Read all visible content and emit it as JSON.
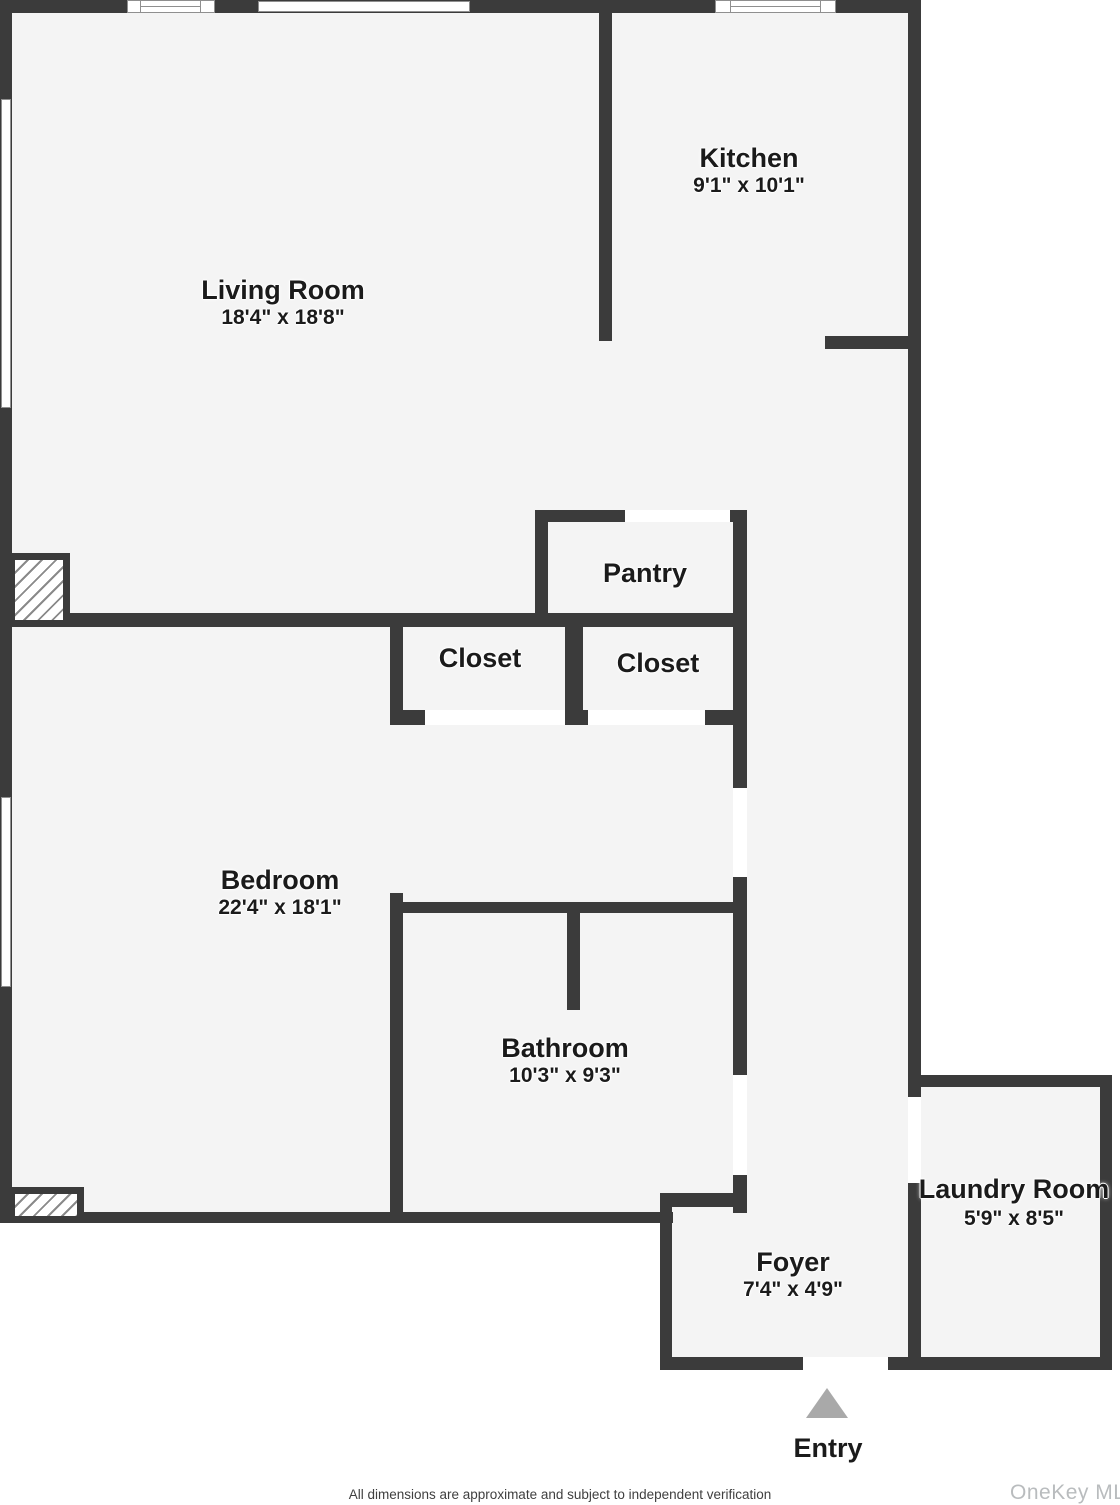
{
  "plan_type": "apartment-floor-plan",
  "colors": {
    "wall": "#3b3b3b",
    "floor": "#f4f4f4",
    "background": "#ffffff",
    "window_border": "#8f8f8f",
    "hatch_line": "#8a8a8a",
    "entry_arrow": "#a9a9a9",
    "label_text": "#1b1b1b",
    "disclaimer_text": "#3f3f3f",
    "watermark_text": "#b9bcbe"
  },
  "rooms": {
    "living_room": {
      "name": "Living Room",
      "dims": "18'4\" x 18'8\""
    },
    "kitchen": {
      "name": "Kitchen",
      "dims": "9'1\" x 10'1\""
    },
    "pantry": {
      "name": "Pantry"
    },
    "closet_a": {
      "name": "Closet"
    },
    "closet_b": {
      "name": "Closet"
    },
    "bedroom": {
      "name": "Bedroom",
      "dims": "22'4\" x 18'1\""
    },
    "bathroom": {
      "name": "Bathroom",
      "dims": "10'3\" x 9'3\""
    },
    "foyer": {
      "name": "Foyer",
      "dims": "7'4\" x 4'9\""
    },
    "laundry_room": {
      "name": "Laundry Room",
      "dims": "5'9\" x 8'5\""
    }
  },
  "entry": {
    "label": "Entry"
  },
  "footer": {
    "disclaimer": "All dimensions are approximate and subject to independent verification",
    "watermark": "OneKey MLS"
  }
}
